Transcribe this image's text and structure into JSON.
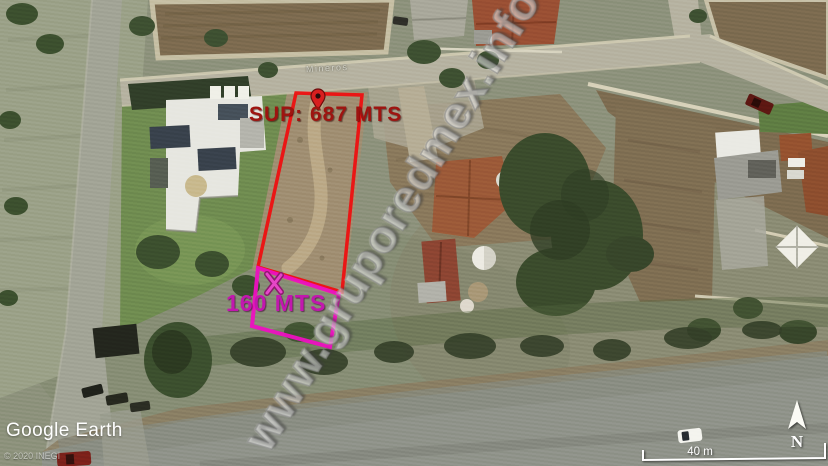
{
  "annotations": {
    "lot_main": {
      "label": "SUP: 687 MTS",
      "outline_color": "#ee1010",
      "text_color": "#9e1410"
    },
    "lot_front": {
      "label": "160 MTS",
      "outline_color": "#ed10c0",
      "text_color": "#c217ae"
    }
  },
  "street_label": "Mineros",
  "watermark": "www.gruporedmex.info",
  "compass": {
    "label": "N"
  },
  "scale_bar": {
    "label": "40 m"
  },
  "branding": {
    "logo": "Google Earth",
    "copyright": "© 2020 INEGI"
  },
  "icons": [
    "location-pin-icon",
    "x-marker-icon",
    "north-arrow-icon"
  ]
}
